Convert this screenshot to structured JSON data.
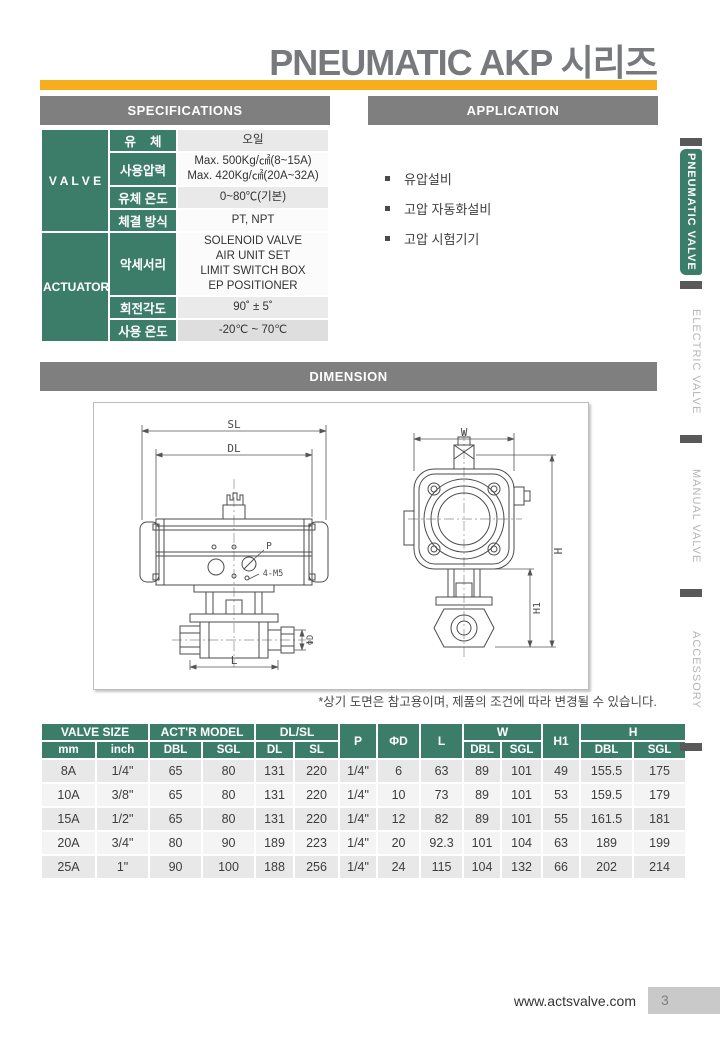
{
  "page": {
    "title": "PNEUMATIC AKP 시리즈",
    "footer_url": "www.actsvalve.com",
    "page_number": "3"
  },
  "colors": {
    "green": "#3C7D69",
    "header_gray": "#7F7F7F",
    "accent_yellow": "#F6AE1E",
    "divider_dark": "#595959",
    "row_dark": "#E8E8E8",
    "row_light": "#F4F4F4"
  },
  "sections": {
    "specifications": {
      "title": "SPECIFICATIONS"
    },
    "application": {
      "title": "APPLICATION"
    },
    "dimension": {
      "title": "DIMENSION"
    }
  },
  "spec_table": {
    "groups": [
      {
        "name": "V A L V E",
        "rows": [
          {
            "label": "유    체",
            "value": "오일",
            "h": 20,
            "bg": "#e9e9e9"
          },
          {
            "label": "사용압력",
            "value": "Max. 500Kg/㎠(8~15A)\nMax. 420Kg/㎠(20A~32A)",
            "h": 32,
            "bg": "#fbfbfb"
          },
          {
            "label": "유체 온도",
            "value": "0~80℃(기본)",
            "h": 20,
            "bg": "#e9e9e9"
          },
          {
            "label": "체결 방식",
            "value": "PT, NPT",
            "h": 20,
            "bg": "#fbfbfb"
          }
        ]
      },
      {
        "name": "ACTUATOR",
        "rows": [
          {
            "label": "악세서리",
            "value": "SOLENOID VALVE\nAIR UNIT SET\nLIMIT SWITCH BOX\nEP POSITIONER",
            "h": 58,
            "bg": "#fbfbfb"
          },
          {
            "label": "회전각도",
            "value": "90˚ ± 5˚",
            "h": 20,
            "bg": "#eaeaea"
          },
          {
            "label": "사용 온도",
            "value": "-20℃ ~ 70℃",
            "h": 20,
            "bg": "#dedede"
          }
        ]
      }
    ]
  },
  "application": {
    "items": [
      "유압설비",
      "고압 자동화설비",
      "고압 시험기기"
    ]
  },
  "dimension": {
    "note": "*상기 도면은 참고용이며, 제품의 조건에 따라 변경될 수 있습니다.",
    "labels": {
      "sl": "SL",
      "dl": "DL",
      "p": "P",
      "m5": "4-M5",
      "l": "L",
      "phi_d": "ΦD",
      "w": "W",
      "h": "H",
      "h1": "H1"
    }
  },
  "dim_table": {
    "top_headers": [
      {
        "label": "VALVE SIZE",
        "colspan": 2,
        "rowspan": 1
      },
      {
        "label": "ACT'R MODEL",
        "colspan": 2,
        "rowspan": 1
      },
      {
        "label": "DL/SL",
        "colspan": 2,
        "rowspan": 1
      },
      {
        "label": "P",
        "colspan": 1,
        "rowspan": 2
      },
      {
        "label": "ΦD",
        "colspan": 1,
        "rowspan": 2
      },
      {
        "label": "L",
        "colspan": 1,
        "rowspan": 2
      },
      {
        "label": "W",
        "colspan": 2,
        "rowspan": 1
      },
      {
        "label": "H1",
        "colspan": 1,
        "rowspan": 2
      },
      {
        "label": "H",
        "colspan": 2,
        "rowspan": 1
      }
    ],
    "sub_headers": [
      "mm",
      "inch",
      "DBL",
      "SGL",
      "DL",
      "SL",
      "DBL",
      "SGL",
      "DBL",
      "SGL"
    ],
    "rows": [
      [
        "8A",
        "1/4\"",
        "65",
        "80",
        "131",
        "220",
        "1/4\"",
        "6",
        "63",
        "89",
        "101",
        "49",
        "155.5",
        "175"
      ],
      [
        "10A",
        "3/8\"",
        "65",
        "80",
        "131",
        "220",
        "1/4\"",
        "10",
        "73",
        "89",
        "101",
        "53",
        "159.5",
        "179"
      ],
      [
        "15A",
        "1/2\"",
        "65",
        "80",
        "131",
        "220",
        "1/4\"",
        "12",
        "82",
        "89",
        "101",
        "55",
        "161.5",
        "181"
      ],
      [
        "20A",
        "3/4\"",
        "80",
        "90",
        "189",
        "223",
        "1/4\"",
        "20",
        "92.3",
        "101",
        "104",
        "63",
        "189",
        "199"
      ],
      [
        "25A",
        "1\"",
        "90",
        "100",
        "188",
        "256",
        "1/4\"",
        "24",
        "115",
        "104",
        "132",
        "66",
        "202",
        "214"
      ]
    ]
  },
  "sidebar": {
    "items": [
      {
        "label": "PNEUMATIC VALVE",
        "active": true
      },
      {
        "label": "ELECTRIC VALVE",
        "active": false
      },
      {
        "label": "MANUAL VALVE",
        "active": false
      },
      {
        "label": "ACCESSORY",
        "active": false
      }
    ]
  }
}
